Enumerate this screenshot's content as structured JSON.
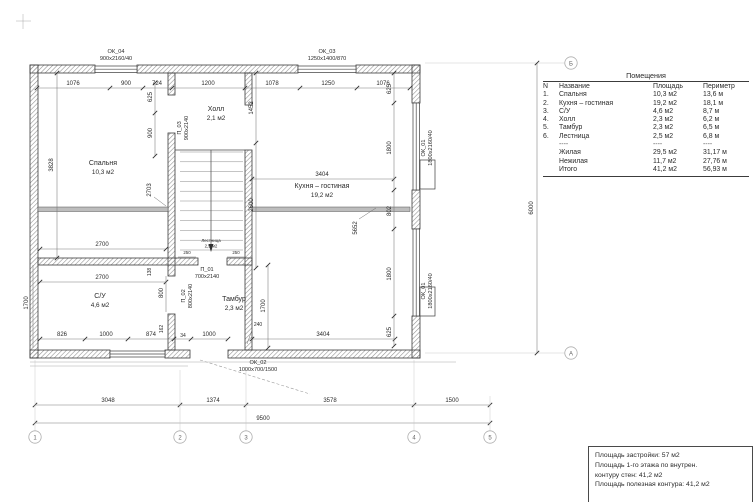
{
  "rooms_table": {
    "title": "Помещения",
    "headers": {
      "num": "N",
      "name": "Название",
      "area": "Площадь",
      "perimeter": "Периметр"
    },
    "rows": [
      {
        "num": "1.",
        "name": "Спальня",
        "area": "10,3 м2",
        "perimeter": "13,6 м"
      },
      {
        "num": "2.",
        "name": "Кухня – гостиная",
        "area": "19,2 м2",
        "perimeter": "18,1 м"
      },
      {
        "num": "3.",
        "name": "С/У",
        "area": "4,6 м2",
        "perimeter": "8,7 м"
      },
      {
        "num": "4.",
        "name": "Холл",
        "area": "2,3 м2",
        "perimeter": "6,2 м"
      },
      {
        "num": "5.",
        "name": "Тамбур",
        "area": "2,3 м2",
        "perimeter": "6,5 м"
      },
      {
        "num": "6.",
        "name": "Лестница",
        "area": "2,5 м2",
        "perimeter": "6,8 м"
      }
    ],
    "separator": {
      "name": "----",
      "area": "----",
      "perimeter": "----"
    },
    "totals": [
      {
        "name": "Жилая",
        "area": "29,5 м2",
        "perimeter": "31,17 м"
      },
      {
        "name": "Нежилая",
        "area": "11,7 м2",
        "perimeter": "27,76 м"
      },
      {
        "name": "Итого",
        "area": "41,2 м2",
        "perimeter": "56,93 м"
      }
    ]
  },
  "summary": {
    "lines": [
      "Площадь застройки: 57 м2",
      "Площадь 1-го этажа по внутрен.",
      "контуру стен: 41,2 м2",
      "Площадь полезная контура: 41,2 м2"
    ]
  },
  "plan": {
    "axes": {
      "h": [
        "1",
        "2",
        "3",
        "4",
        "5"
      ],
      "v": [
        "Б",
        "А"
      ]
    },
    "rooms": {
      "bedroom": {
        "name": "Спальня",
        "area": "10,3 м2"
      },
      "hall": {
        "name": "Холл",
        "area": "2,1 м2"
      },
      "kitchen": {
        "name": "Кухня – гостиная",
        "area": "19,2 м2"
      },
      "wc": {
        "name": "С/У",
        "area": "4,6 м2"
      },
      "tambour": {
        "name": "Тамбур",
        "area": "2,3 м2"
      },
      "stairs": {
        "name": "Лестница",
        "area": "2,5 м2"
      }
    },
    "openings": {
      "ok04": {
        "id": "ОК_04",
        "size": "900х2160/40"
      },
      "ok03": {
        "id": "ОК_03",
        "size": "1250х1400/870"
      },
      "ok01": {
        "id": "ОК_01",
        "size": "1800х2160/40"
      },
      "ok02": {
        "id": "ОК_02",
        "size": "1000х700/1500"
      },
      "d01": {
        "id": "П_01",
        "size": "700х2140"
      },
      "d02": {
        "id": "П_02",
        "size": "800х2140"
      },
      "d03": {
        "id": "П_03",
        "size": "900х2140"
      }
    },
    "dims": {
      "top": [
        "1076",
        "900",
        "724",
        "1200",
        "1078",
        "1250",
        "1076"
      ],
      "bottom": [
        "826",
        "1000",
        "874",
        "34",
        "1000"
      ],
      "axis": [
        "3048",
        "1374",
        "3578",
        "1500"
      ],
      "total_w": "9500",
      "total_h": "6000",
      "v_left": [
        "3828",
        "1700"
      ],
      "v_bed": [
        "625",
        "900",
        "2703",
        "138",
        "800",
        "162"
      ],
      "v_mid": [
        "1452",
        "2600",
        "1700",
        "240"
      ],
      "v_right": [
        "625",
        "1800",
        "802",
        "1800",
        "625"
      ],
      "kitchen_w": [
        "3404",
        "3404"
      ],
      "room_w": [
        "2700",
        "2700"
      ],
      "stair": [
        "250",
        "250"
      ],
      "leader": "5652"
    }
  }
}
